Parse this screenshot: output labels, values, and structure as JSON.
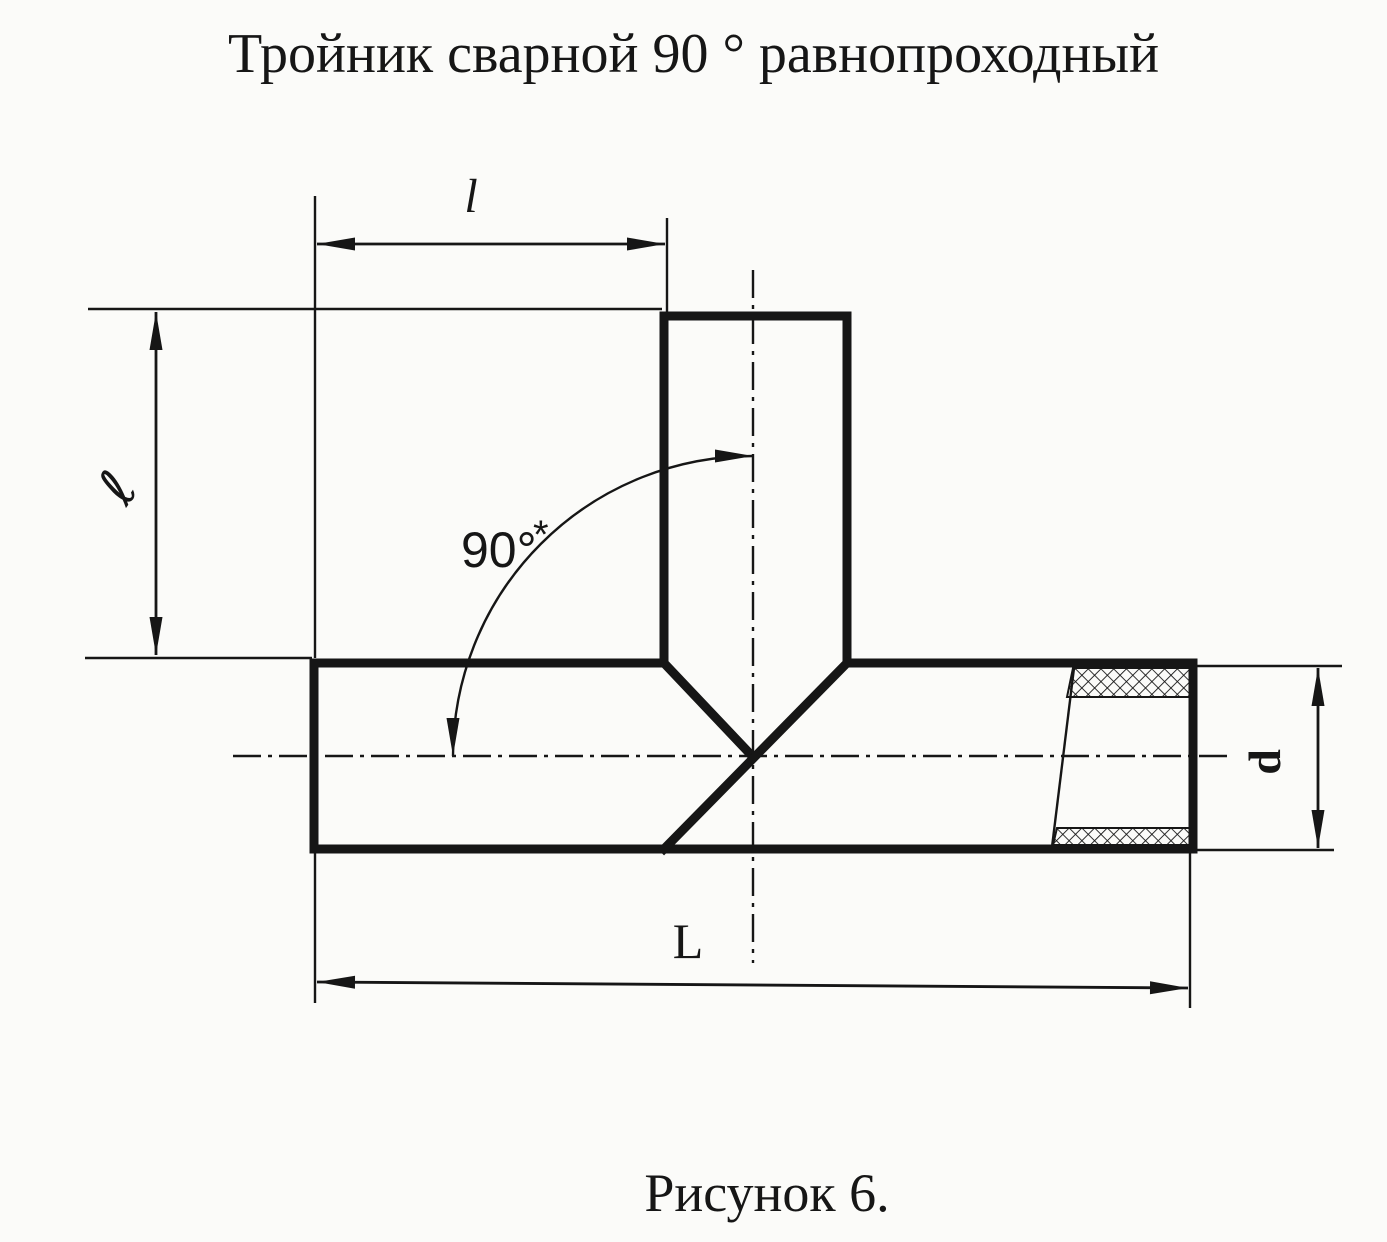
{
  "title": "Тройник сварной 90 ° равнопроходный",
  "caption": "Рисунок 6.",
  "figure": {
    "kind": "technical-drawing",
    "subject": "welded 90-degree equal-bore tee pipe fitting, front view with partial section at right end"
  },
  "labels": {
    "branch_offset": "l",
    "branch_height": "ℓ",
    "overall_length": "L",
    "diameter": "d",
    "angle": "90°",
    "angle_note": "*"
  },
  "colors": {
    "ink": "#161616",
    "paper": "#fbfbf9"
  }
}
